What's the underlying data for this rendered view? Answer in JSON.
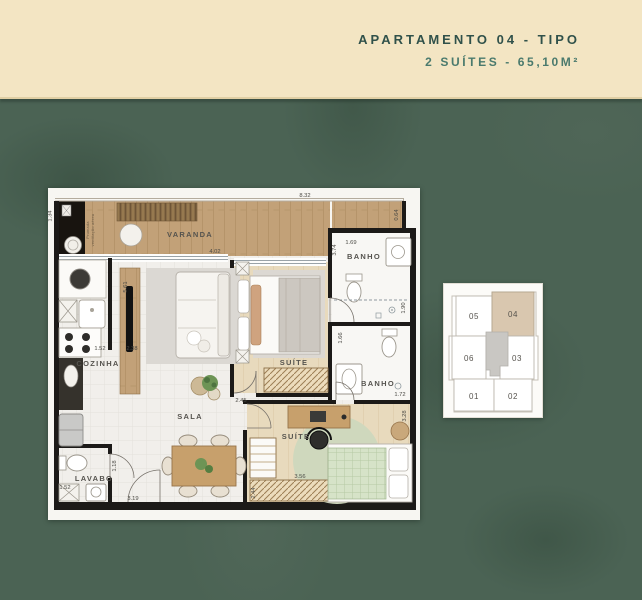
{
  "header": {
    "title": "APARTAMENTO 04 - TIPO",
    "subtitle": "2 SUÍTES - 65,10M²"
  },
  "floorplan": {
    "labels": {
      "varanda": "VARANDA",
      "cozinha": "COZINHA",
      "sala": "SALA",
      "lavabo": "LAVABO",
      "suite1": "SUÍTE",
      "suite2": "SUÍTE",
      "banho1": "BANHO",
      "banho2": "BANHO",
      "shaft_line1": "Prumada",
      "shaft_line2": "ventilação aérea"
    },
    "dimensions": {
      "varanda_total": "8.32",
      "varanda_right": "0.64",
      "shaft_width": "1.34",
      "varanda_sala": "4.02",
      "banho1_width": "1.69",
      "banho1_depth": "3.74",
      "banho1_shower": "1.90",
      "divider_height": "5.61",
      "cozinha_width": "1.52",
      "sala_width": "2.38",
      "suite1_door": "2.45",
      "banho2_depth": "1.66",
      "banho2_width": "1.72",
      "suite2_side": "3.28",
      "suite2_width": "3.56",
      "suite2_depth": "2.44",
      "sala_bottom": "3.19",
      "hall_depth": "1.18",
      "lavabo_width": "1.52"
    }
  },
  "keyplan": {
    "highlight_color": "#d9c7af",
    "units": [
      {
        "id": "05"
      },
      {
        "id": "04",
        "highlighted": true
      },
      {
        "id": "06"
      },
      {
        "id": "03"
      },
      {
        "id": "01"
      },
      {
        "id": "02"
      }
    ]
  },
  "colors": {
    "background_green": "#4b6354",
    "band_cream": "#f3e5c3",
    "title_teal": "#30514a",
    "subtitle_teal": "#4a7a6d"
  }
}
